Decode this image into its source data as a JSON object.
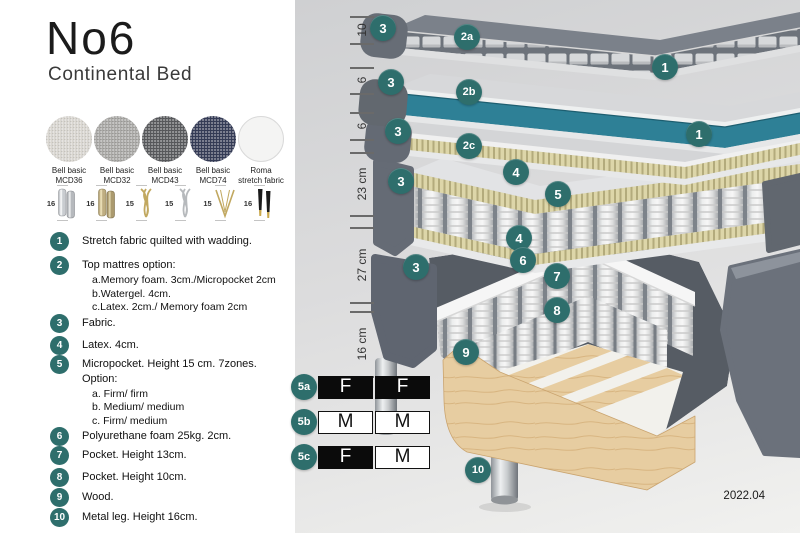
{
  "colors": {
    "teal": "#2e6e6c",
    "watergel": "#2e8096",
    "slate": "#696f79",
    "latex_bg": "#ddd6a9",
    "latex_stripe": "#b3ab7c",
    "wood": "#e7cda1"
  },
  "left_panel": {
    "title": "No6",
    "subtitle": "Continental Bed",
    "swatches": [
      {
        "line1": "Bell basic",
        "line2": "MCD36",
        "style": "sw-light-weave"
      },
      {
        "line1": "Bell basic",
        "line2": "MCD32",
        "style": "sw-gray-weave"
      },
      {
        "line1": "Bell basic",
        "line2": "MCD43",
        "style": "sw-darkgray-weave"
      },
      {
        "line1": "Bell basic",
        "line2": "MCD74",
        "style": "sw-navy-weave"
      },
      {
        "line1": "Roma",
        "line2": "stretch fabric",
        "style": "sw-white-plain"
      }
    ],
    "legs": [
      {
        "height": "16",
        "style": "cylinder-silver"
      },
      {
        "height": "16",
        "style": "cylinder-brass"
      },
      {
        "height": "15",
        "style": "twist-gold"
      },
      {
        "height": "15",
        "style": "twist-silver"
      },
      {
        "height": "15",
        "style": "hairpin-gold"
      },
      {
        "height": "16",
        "style": "taper-black-gold"
      }
    ],
    "spec_list": [
      {
        "num": "1",
        "text": "Stretch fabric quilted with wadding.",
        "sub": []
      },
      {
        "num": "2",
        "text": "Top mattres option:",
        "sub": [
          "a.Memory foam. 3cm./Micropocket 2cm",
          "b.Watergel. 4cm.",
          "c.Latex. 2cm./ Memory foam 2cm"
        ]
      },
      {
        "num": "3",
        "text": "Fabric.",
        "sub": []
      },
      {
        "num": "4",
        "text": "Latex. 4cm.",
        "sub": []
      },
      {
        "num": "5",
        "text": "Micropocket. Height 15 cm. 7zones. Option:",
        "sub": [
          "a. Firm/ firm",
          "b. Medium/ medium",
          "c. Firm/ medium"
        ]
      },
      {
        "num": "6",
        "text": "Polyurethane foam 25kg. 2cm.",
        "sub": []
      },
      {
        "num": "7",
        "text": "Pocket. Height 13cm.",
        "sub": []
      },
      {
        "num": "8",
        "text": "Pocket. Height 10cm.",
        "sub": []
      },
      {
        "num": "9",
        "text": "Wood.",
        "sub": []
      },
      {
        "num": "10",
        "text": "Metal leg. Height 16cm.",
        "sub": []
      }
    ]
  },
  "diagram": {
    "ruler": [
      {
        "label": "10",
        "from": 16,
        "to": 43
      },
      {
        "label": "6",
        "from": 67,
        "to": 93
      },
      {
        "label": "6",
        "from": 112,
        "to": 139
      },
      {
        "label": "23 cm",
        "from": 152,
        "to": 215
      },
      {
        "label": "27 cm",
        "from": 227,
        "to": 302
      },
      {
        "label": "16 cm",
        "from": 311,
        "to": 376
      }
    ],
    "callouts": [
      {
        "label": "3",
        "x": 88,
        "y": 28
      },
      {
        "label": "2a",
        "x": 172,
        "y": 37
      },
      {
        "label": "1",
        "x": 370,
        "y": 67
      },
      {
        "label": "3",
        "x": 96,
        "y": 82
      },
      {
        "label": "2b",
        "x": 174,
        "y": 92
      },
      {
        "label": "3",
        "x": 103,
        "y": 131
      },
      {
        "label": "2c",
        "x": 174,
        "y": 146
      },
      {
        "label": "1",
        "x": 404,
        "y": 134
      },
      {
        "label": "3",
        "x": 106,
        "y": 181
      },
      {
        "label": "4",
        "x": 221,
        "y": 172
      },
      {
        "label": "5",
        "x": 263,
        "y": 194
      },
      {
        "label": "4",
        "x": 224,
        "y": 238
      },
      {
        "label": "6",
        "x": 228,
        "y": 260
      },
      {
        "label": "3",
        "x": 121,
        "y": 267
      },
      {
        "label": "7",
        "x": 262,
        "y": 276
      },
      {
        "label": "8",
        "x": 262,
        "y": 310
      },
      {
        "label": "9",
        "x": 171,
        "y": 352
      },
      {
        "label": "10",
        "x": 183,
        "y": 470
      }
    ],
    "firmness": {
      "rows": [
        {
          "id": "5a",
          "y": 387,
          "cells": [
            {
              "label": "F",
              "filled": true
            },
            {
              "label": "F",
              "filled": true
            }
          ]
        },
        {
          "id": "5b",
          "y": 422,
          "cells": [
            {
              "label": "M",
              "filled": false
            },
            {
              "label": "M",
              "filled": false
            }
          ]
        },
        {
          "id": "5c",
          "y": 457,
          "cells": [
            {
              "label": "F",
              "filled": true
            },
            {
              "label": "M",
              "filled": false
            }
          ]
        }
      ]
    },
    "version_label": "2022.04"
  }
}
